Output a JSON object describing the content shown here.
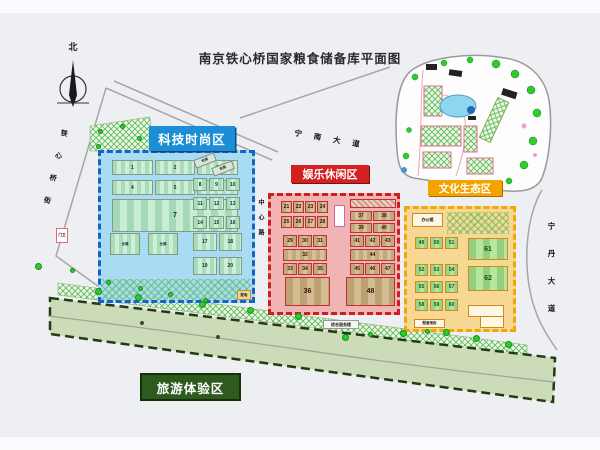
{
  "title": "南京铁心桥国家粮食储备库平面图",
  "compass": {
    "north": "北"
  },
  "zones": {
    "tech": {
      "label": "科技时尚区",
      "grid_a": [
        [
          "1",
          "2",
          "3"
        ],
        [
          "4",
          "5",
          "6"
        ]
      ],
      "b7": "7",
      "pair": [
        [
          "仓库",
          "仓库"
        ]
      ],
      "col_a": [
        [
          "8",
          "9",
          "10"
        ],
        [
          "11",
          "12",
          "13"
        ],
        [
          "14",
          "15",
          "16"
        ]
      ],
      "col_b": [
        [
          "17",
          "18"
        ]
      ],
      "col_c": [
        [
          "19",
          "20"
        ]
      ],
      "slant_a": "仓库",
      "slant_b": "仓库",
      "power_box": "配电"
    },
    "fun": {
      "label": "娱乐休闲区",
      "grid_a": [
        [
          "21",
          "22",
          "23",
          "24"
        ],
        [
          "25",
          "26",
          "27",
          "28"
        ]
      ],
      "grid_b": [
        [
          "29",
          "30",
          "31"
        ],
        [
          "32"
        ],
        [
          "33",
          "34",
          "35"
        ]
      ],
      "b36": "36",
      "grid_c": [
        [
          "37",
          "38"
        ],
        [
          "39",
          "40"
        ]
      ],
      "grid_d": [
        [
          "41",
          "42",
          "43"
        ],
        [
          "44"
        ],
        [
          "45",
          "46",
          "47"
        ]
      ],
      "b48": "48"
    },
    "culture": {
      "label": "文化生态区",
      "grid_a": [
        [
          "49",
          "50",
          "51"
        ]
      ],
      "grid_b": [
        [
          "52",
          "53",
          "54"
        ],
        [
          "55",
          "56",
          "57"
        ]
      ],
      "grid_c": [
        [
          "58",
          "59",
          "60"
        ]
      ],
      "b61": "61",
      "b62": "62",
      "office": "办公楼",
      "annex": "配套用房"
    },
    "tour": {
      "label": "旅游体验区"
    }
  },
  "roads": {
    "top": "宁南大道",
    "left": "铁心桥街",
    "right": "宁丹大道",
    "mid": "中心路"
  },
  "misc": {
    "guard": "门卫",
    "service": "综合服务楼"
  },
  "colors": {
    "tech": "#1b8ed6",
    "fun": "#d32020",
    "culture": "#f3a300",
    "tour": "#2f5a1d"
  }
}
